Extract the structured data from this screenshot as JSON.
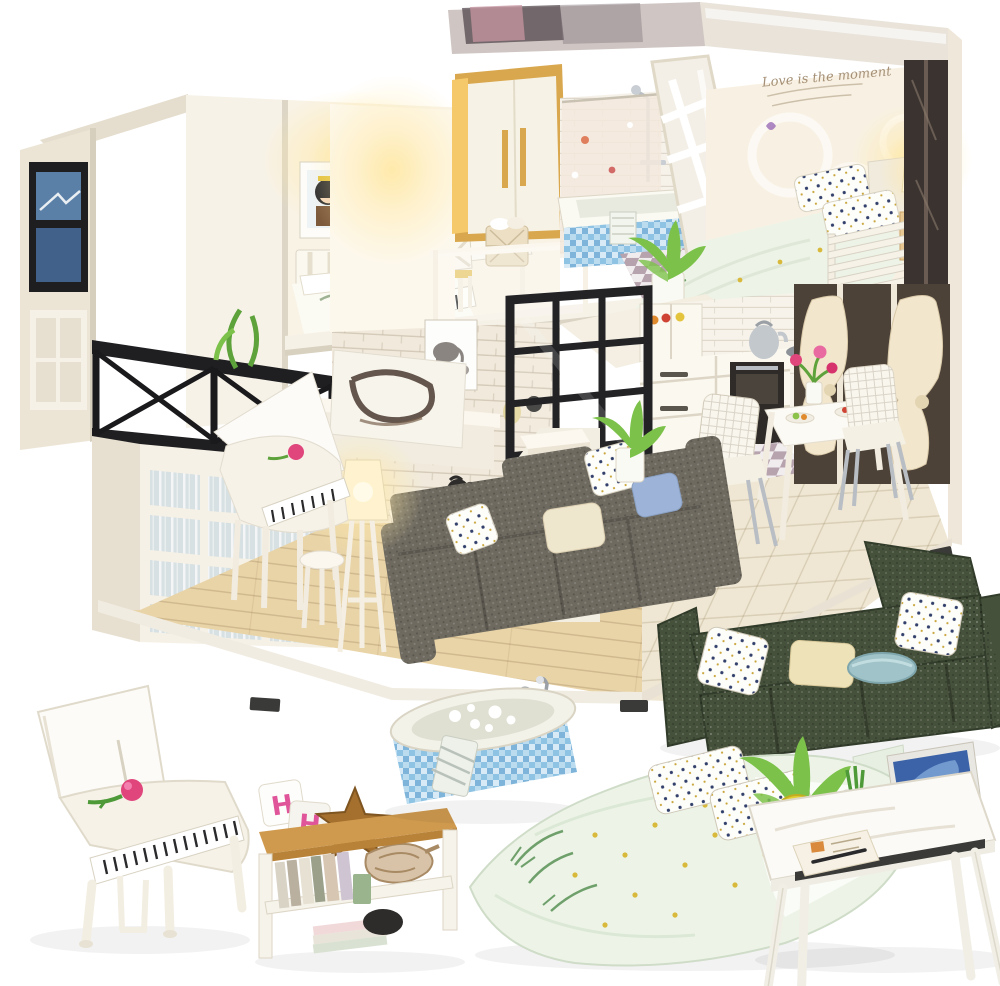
{
  "meta": {
    "image_type": "product-photo",
    "subject": "DIY miniature dollhouse kit: two-story modern loft with LED-lit rooms, shown above close-up shots of the included furniture miniatures"
  },
  "texts": {
    "wall_quote": "Love is the moment",
    "letter_cube_1": "H",
    "letter_cube_2": "H"
  },
  "palette": {
    "background": "#ffffff",
    "exterior_wall": "#efe8da",
    "interior_wall": "#f9f3e6",
    "bright_wall": "#fdf8ec",
    "warm_glow": "#ffe9a8",
    "wood_floor": "#e9d4a8",
    "wood_shelf": "#cf9a4e",
    "wardrobe_gold": "#d9a84e",
    "brick_wall": "#f1eadc",
    "black_frame": "#232326",
    "tile_blue": "#8ec3e4",
    "sofa_gray": "#6e6a60",
    "sofa_green": "#46513b",
    "plant_green": "#7cc24a",
    "pot_yellow": "#e3ce33",
    "rose_pink": "#e0457b",
    "laptop_screen": "#3c63a8",
    "curtain_cream": "#f2e6cd",
    "floor_check_purple": "#b7a3ad",
    "dining_floor": "#efe7d3",
    "bedding_mint": "#edf4e7",
    "letter_pink": "#e0559a",
    "pillow_navy": "#32406b",
    "starfish_brown": "#a5702e"
  },
  "house": {
    "rooms": [
      "study bedroom",
      "wardrobe nook",
      "bathroom",
      "master bedroom",
      "living room",
      "kitchen",
      "dining corner",
      "staircase loft"
    ]
  },
  "products": [
    "white grand piano",
    "bookshelf with shells and letter cubes",
    "mosaic bathtub",
    "floral double bed",
    "dark green corner sofa",
    "writing desk with laptop and plant"
  ]
}
